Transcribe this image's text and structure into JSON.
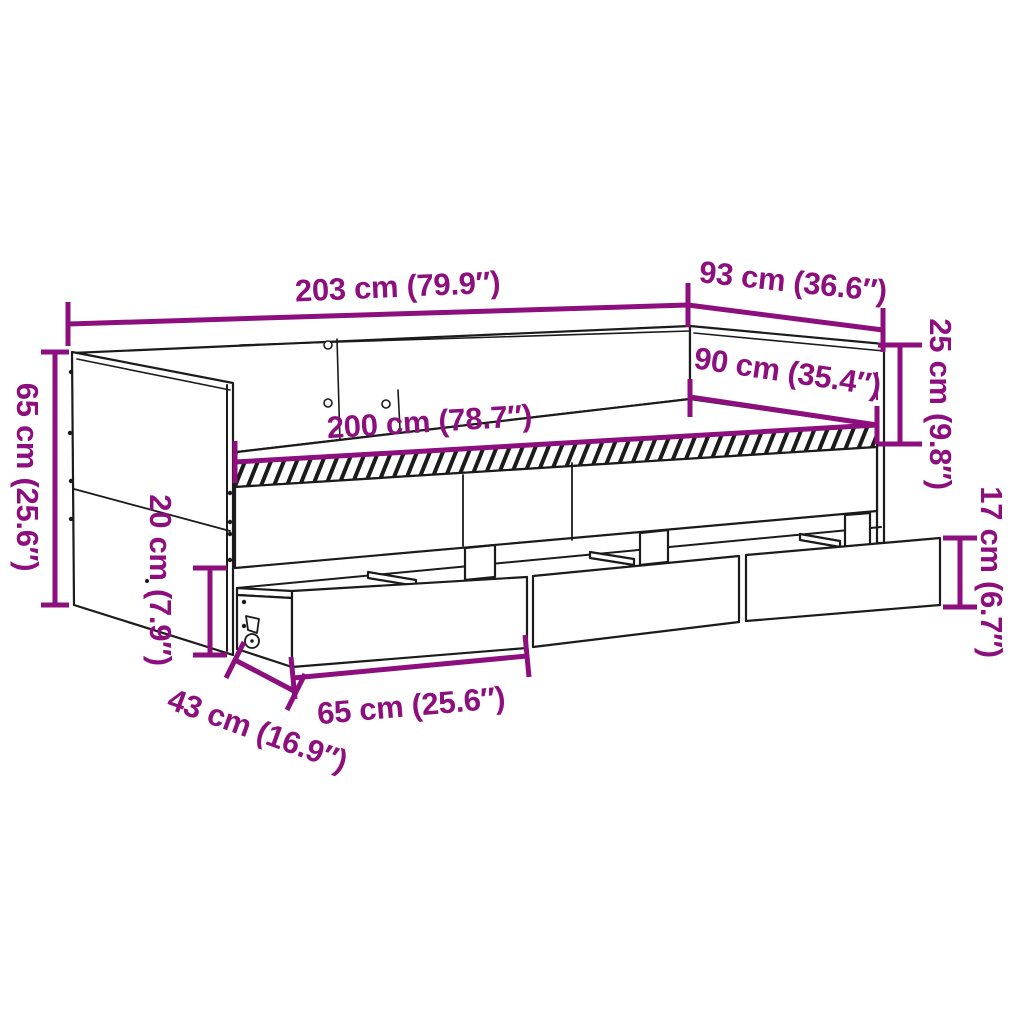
{
  "diagram": {
    "kind": "furniture-dimension-diagram",
    "product": "daybed with 3 storage drawers",
    "accent_color": "#8d0f7e",
    "line_color": "#1b1b1b",
    "background_color": "#ffffff",
    "labels": {
      "total_width": "203 cm (79.9″)",
      "total_depth": "93 cm (36.6″)",
      "rail_to_slats_height": "25 cm (9.8″)",
      "sleeping_width": "90 cm (35.4″)",
      "sleeping_length": "200 cm (78.7″)",
      "total_height": "65 cm (25.6″)",
      "underbed_clearance": "20 cm (7.9″)",
      "drawer_front_height": "17 cm (6.7″)",
      "drawer_depth": "43 cm (16.9″)",
      "drawer_width": "65 cm (25.6″)"
    }
  }
}
